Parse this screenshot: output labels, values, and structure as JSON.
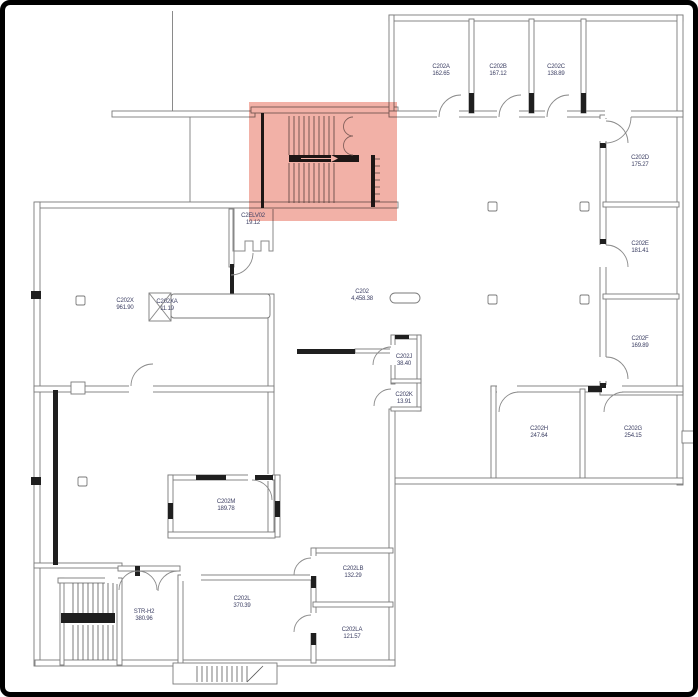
{
  "floorplan": {
    "title": "floor-plan-level-2",
    "highlight": {
      "region": "stairwell",
      "color_hex": "#e8705e"
    },
    "rooms": [
      {
        "id": "C202A",
        "area": "162.65",
        "x": 436,
        "y": 66
      },
      {
        "id": "C202B",
        "area": "167.12",
        "x": 493,
        "y": 66
      },
      {
        "id": "C202C",
        "area": "138.89",
        "x": 551,
        "y": 66
      },
      {
        "id": "C202D",
        "area": "175.27",
        "x": 635,
        "y": 157
      },
      {
        "id": "C202E",
        "area": "181.41",
        "x": 635,
        "y": 243
      },
      {
        "id": "C202F",
        "area": "169.89",
        "x": 635,
        "y": 338
      },
      {
        "id": "C202G",
        "area": "254.15",
        "x": 628,
        "y": 428
      },
      {
        "id": "C202H",
        "area": "247.64",
        "x": 534,
        "y": 428
      },
      {
        "id": "C202",
        "area": "4,458.38",
        "x": 357,
        "y": 291
      },
      {
        "id": "C202X",
        "area": "961.90",
        "x": 120,
        "y": 300
      },
      {
        "id": "C202XA",
        "area": "11.19",
        "x": 162,
        "y": 301
      },
      {
        "id": "C2ELV02",
        "area": "19.12",
        "x": 248,
        "y": 215
      },
      {
        "id": "C202J",
        "area": "38.40",
        "x": 399,
        "y": 356
      },
      {
        "id": "C202K",
        "area": "13.91",
        "x": 399,
        "y": 394
      },
      {
        "id": "C202M",
        "area": "189.78",
        "x": 221,
        "y": 501
      },
      {
        "id": "C202L",
        "area": "370.39",
        "x": 237,
        "y": 598
      },
      {
        "id": "C202LB",
        "area": "132.29",
        "x": 348,
        "y": 568
      },
      {
        "id": "C202LA",
        "area": "121.57",
        "x": 347,
        "y": 629
      },
      {
        "id": "STR-H2",
        "area": "380.96",
        "x": 139,
        "y": 611
      }
    ]
  }
}
